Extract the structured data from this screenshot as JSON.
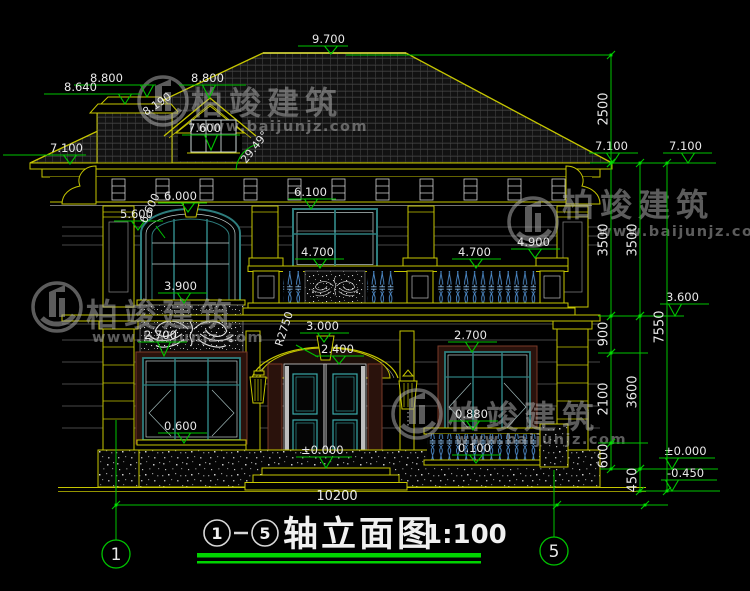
{
  "palette": {
    "dim_green": "#00c400",
    "bright_green": "#00e000",
    "line_yellow": "#c6c600",
    "text_white": "#e9e9e9",
    "frame_cyan": "#2e7d7d",
    "frame_light": "#c2cfcf",
    "baluster_blue": "#5c9ad6",
    "surround_maroon": "#7a3a28",
    "watermark_gray": "#b0b0b0"
  },
  "watermark": {
    "brand": "柏竣建筑",
    "url": "www.baijunjz.com",
    "instances": [
      {
        "lx": 163,
        "ly": 101,
        "tx": 191,
        "ty": 114,
        "ux": 196,
        "uy": 131
      },
      {
        "lx": 57,
        "ly": 307,
        "tx": 86,
        "ty": 326,
        "ux": 92,
        "uy": 342
      },
      {
        "lx": 417,
        "ly": 414,
        "tx": 448,
        "ty": 428,
        "ux": 455,
        "uy": 444
      },
      {
        "lx": 533,
        "ly": 222,
        "tx": 562,
        "ty": 216,
        "ux": 598,
        "uy": 236
      }
    ]
  },
  "annotations": {
    "levels": [
      {
        "label": "9.700",
        "tx": 312,
        "lx1": 298,
        "lx2": 348,
        "ly": 46,
        "ax": 331,
        "ay": 54
      },
      {
        "label": "8.800",
        "tx": 90,
        "lx1": 74,
        "lx2": 156,
        "ly": 85,
        "ax": 147,
        "ay": 97
      },
      {
        "label": "8.640",
        "tx": 64,
        "lx1": 44,
        "lx2": 140,
        "ly": 94,
        "ax": 125,
        "ay": 104
      },
      {
        "label": "8.800",
        "tx": 191,
        "lx1": 179,
        "lx2": 246,
        "ly": 85,
        "ax": 209,
        "ay": 98
      },
      {
        "label": "7.600",
        "tx": 188,
        "lx1": 182,
        "lx2": 240,
        "ly": 135,
        "ax": 211,
        "ay": 150
      },
      {
        "label": "7.100",
        "tx": 50,
        "lx1": 3,
        "lx2": 86,
        "ly": 155,
        "ax": 70,
        "ay": 164
      },
      {
        "label": "6.100",
        "tx": 294,
        "lx1": 288,
        "lx2": 336,
        "ly": 199,
        "ax": 311,
        "ay": 209
      },
      {
        "label": "6.000",
        "tx": 164,
        "lx1": 158,
        "lx2": 207,
        "ly": 203,
        "ax": 188,
        "ay": 212
      },
      {
        "label": "5.600",
        "tx": 120,
        "lx1": 114,
        "lx2": 163,
        "ly": 221,
        "ax": 138,
        "ay": 230
      },
      {
        "label": "3.900",
        "tx": 164,
        "lx1": 158,
        "lx2": 207,
        "ly": 293,
        "ax": 184,
        "ay": 303
      },
      {
        "label": "2.700",
        "tx": 144,
        "lx1": 138,
        "lx2": 187,
        "ly": 342,
        "ax": 164,
        "ay": 356
      },
      {
        "label": "0.600",
        "tx": 164,
        "lx1": 158,
        "lx2": 207,
        "ly": 433,
        "ax": 184,
        "ay": 443
      },
      {
        "label": "4.700",
        "tx": 301,
        "lx1": 295,
        "lx2": 344,
        "ly": 259,
        "ax": 320,
        "ay": 268
      },
      {
        "label": "4.700",
        "tx": 458,
        "lx1": 452,
        "lx2": 501,
        "ly": 259,
        "ax": 476,
        "ay": 268
      },
      {
        "label": "4.900",
        "tx": 517,
        "lx1": 511,
        "lx2": 560,
        "ly": 249,
        "ax": 535,
        "ay": 258
      },
      {
        "label": "3.000",
        "tx": 306,
        "lx1": 300,
        "lx2": 349,
        "ly": 333,
        "ax": 324,
        "ay": 342
      },
      {
        "label": "2.400",
        "tx": 321,
        "lx1": 315,
        "lx2": 364,
        "ly": 356,
        "ax": 339,
        "ay": 364
      },
      {
        "label": "±0.000",
        "tx": 301,
        "lx1": 296,
        "lx2": 352,
        "ly": 457,
        "ax": 326,
        "ay": 468
      },
      {
        "label": "2.700",
        "tx": 454,
        "lx1": 448,
        "lx2": 497,
        "ly": 342,
        "ax": 472,
        "ay": 352
      },
      {
        "label": "0.880",
        "tx": 455,
        "lx1": 449,
        "lx2": 498,
        "ly": 421,
        "ax": 473,
        "ay": 430
      },
      {
        "label": "0.100",
        "tx": 458,
        "lx1": 452,
        "lx2": 501,
        "ly": 455,
        "ax": 476,
        "ay": 463
      },
      {
        "label": "7.100",
        "tx": 595,
        "lx1": 589,
        "lx2": 638,
        "ly": 153,
        "ax": 613,
        "ay": 163
      },
      {
        "label": "7.100",
        "tx": 669,
        "lx1": 663,
        "lx2": 712,
        "ly": 153,
        "ax": 688,
        "ay": 163
      },
      {
        "label": "3.600",
        "tx": 666,
        "lx1": 660,
        "lx2": 709,
        "ly": 304,
        "ax": 675,
        "ay": 316
      },
      {
        "label": "±0.000",
        "tx": 664,
        "lx1": 659,
        "lx2": 715,
        "ly": 458,
        "ax": 672,
        "ay": 469
      },
      {
        "label": "-0.450",
        "tx": 667,
        "lx1": 661,
        "lx2": 717,
        "ly": 480,
        "ax": 672,
        "ay": 491
      }
    ],
    "vdims": [
      {
        "label": "2500",
        "x": 611,
        "y1": 55,
        "y2": 163,
        "ty": 109
      },
      {
        "label": "3500",
        "x": 611,
        "y1": 163,
        "y2": 316,
        "ty": 240
      },
      {
        "label": "900",
        "x": 611,
        "y1": 316,
        "y2": 353,
        "ty": 334
      },
      {
        "label": "2100",
        "x": 611,
        "y1": 353,
        "y2": 443,
        "ty": 399
      },
      {
        "label": "600",
        "x": 611,
        "y1": 443,
        "y2": 469,
        "ty": 456
      },
      {
        "label": "3500",
        "x": 640,
        "y1": 163,
        "y2": 316,
        "ty": 240
      },
      {
        "label": "3600",
        "x": 640,
        "y1": 316,
        "y2": 469,
        "ty": 392
      },
      {
        "label": "450",
        "x": 640,
        "y1": 469,
        "y2": 491,
        "ty": 480
      },
      {
        "label": "7550",
        "x": 667,
        "y1": 163,
        "y2": 491,
        "ty": 327
      }
    ],
    "hdims": [
      {
        "label": "10200",
        "y": 505,
        "x1": 116,
        "x2": 668,
        "ticks": [
          116,
          557,
          645
        ],
        "tx": 337,
        "ty": 500
      }
    ],
    "rotated": [
      {
        "label": "8.190",
        "x": 146,
        "y": 116,
        "rot": -34
      },
      {
        "label": "29.49°",
        "x": 246,
        "y": 164,
        "rot": -52
      },
      {
        "label": "6.600",
        "x": 146,
        "y": 224,
        "rot": -64
      },
      {
        "label": "R2750",
        "x": 282,
        "y": 347,
        "rot": -72
      }
    ]
  },
  "axis_bubbles": [
    {
      "label": "1",
      "cx": 116,
      "cy": 554
    },
    {
      "label": "5",
      "cx": 554,
      "cy": 551
    }
  ],
  "title_block": {
    "axis_from": "1",
    "separator": "-",
    "axis_to": "5",
    "title": "轴立面图",
    "scale": "1:100"
  }
}
